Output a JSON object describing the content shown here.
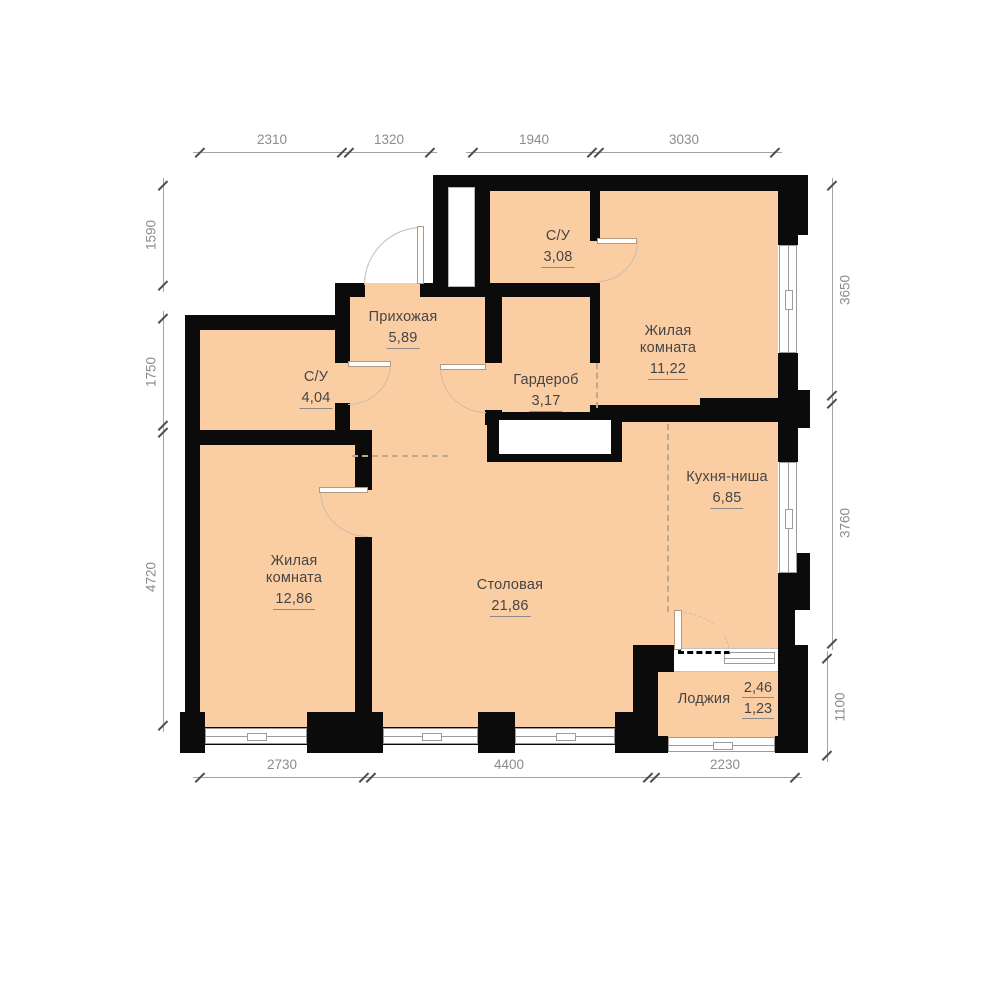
{
  "rooms": [
    {
      "key": "bathroom-top",
      "name": "С/У",
      "area": "3,08"
    },
    {
      "key": "hallway",
      "name": "Прихожая",
      "area": "5,89"
    },
    {
      "key": "bathroom-left",
      "name": "С/У",
      "area": "4,04"
    },
    {
      "key": "wardrobe",
      "name": "Гардероб",
      "area": "3,17"
    },
    {
      "key": "living-room-top",
      "name": "Жилая комната",
      "area": "11,22"
    },
    {
      "key": "kitchen-niche",
      "name": "Кухня-ниша",
      "area": "6,85"
    },
    {
      "key": "living-room-left",
      "name": "Жилая комната",
      "area": "12,86"
    },
    {
      "key": "dining-room",
      "name": "Столовая",
      "area": "21,86"
    },
    {
      "key": "loggia",
      "name": "Лоджия",
      "area": "2,46",
      "area_secondary": "1,23"
    }
  ],
  "dimensions_mm": {
    "top": [
      "2310",
      "1320",
      "1940",
      "3030"
    ],
    "bottom": [
      "2730",
      "4400",
      "2230"
    ],
    "left": [
      "1590",
      "1750",
      "4720"
    ],
    "right": [
      "3650",
      "3760",
      "1100"
    ]
  },
  "colors": {
    "room_fill": "#fbcda3",
    "wall": "#0b0b0b",
    "dimension_text": "#8c8c8c",
    "label_text": "#454545",
    "dashed": "#bfa88e",
    "window_frame": "#9b9b9b",
    "door_arc": "#c9bcab"
  }
}
